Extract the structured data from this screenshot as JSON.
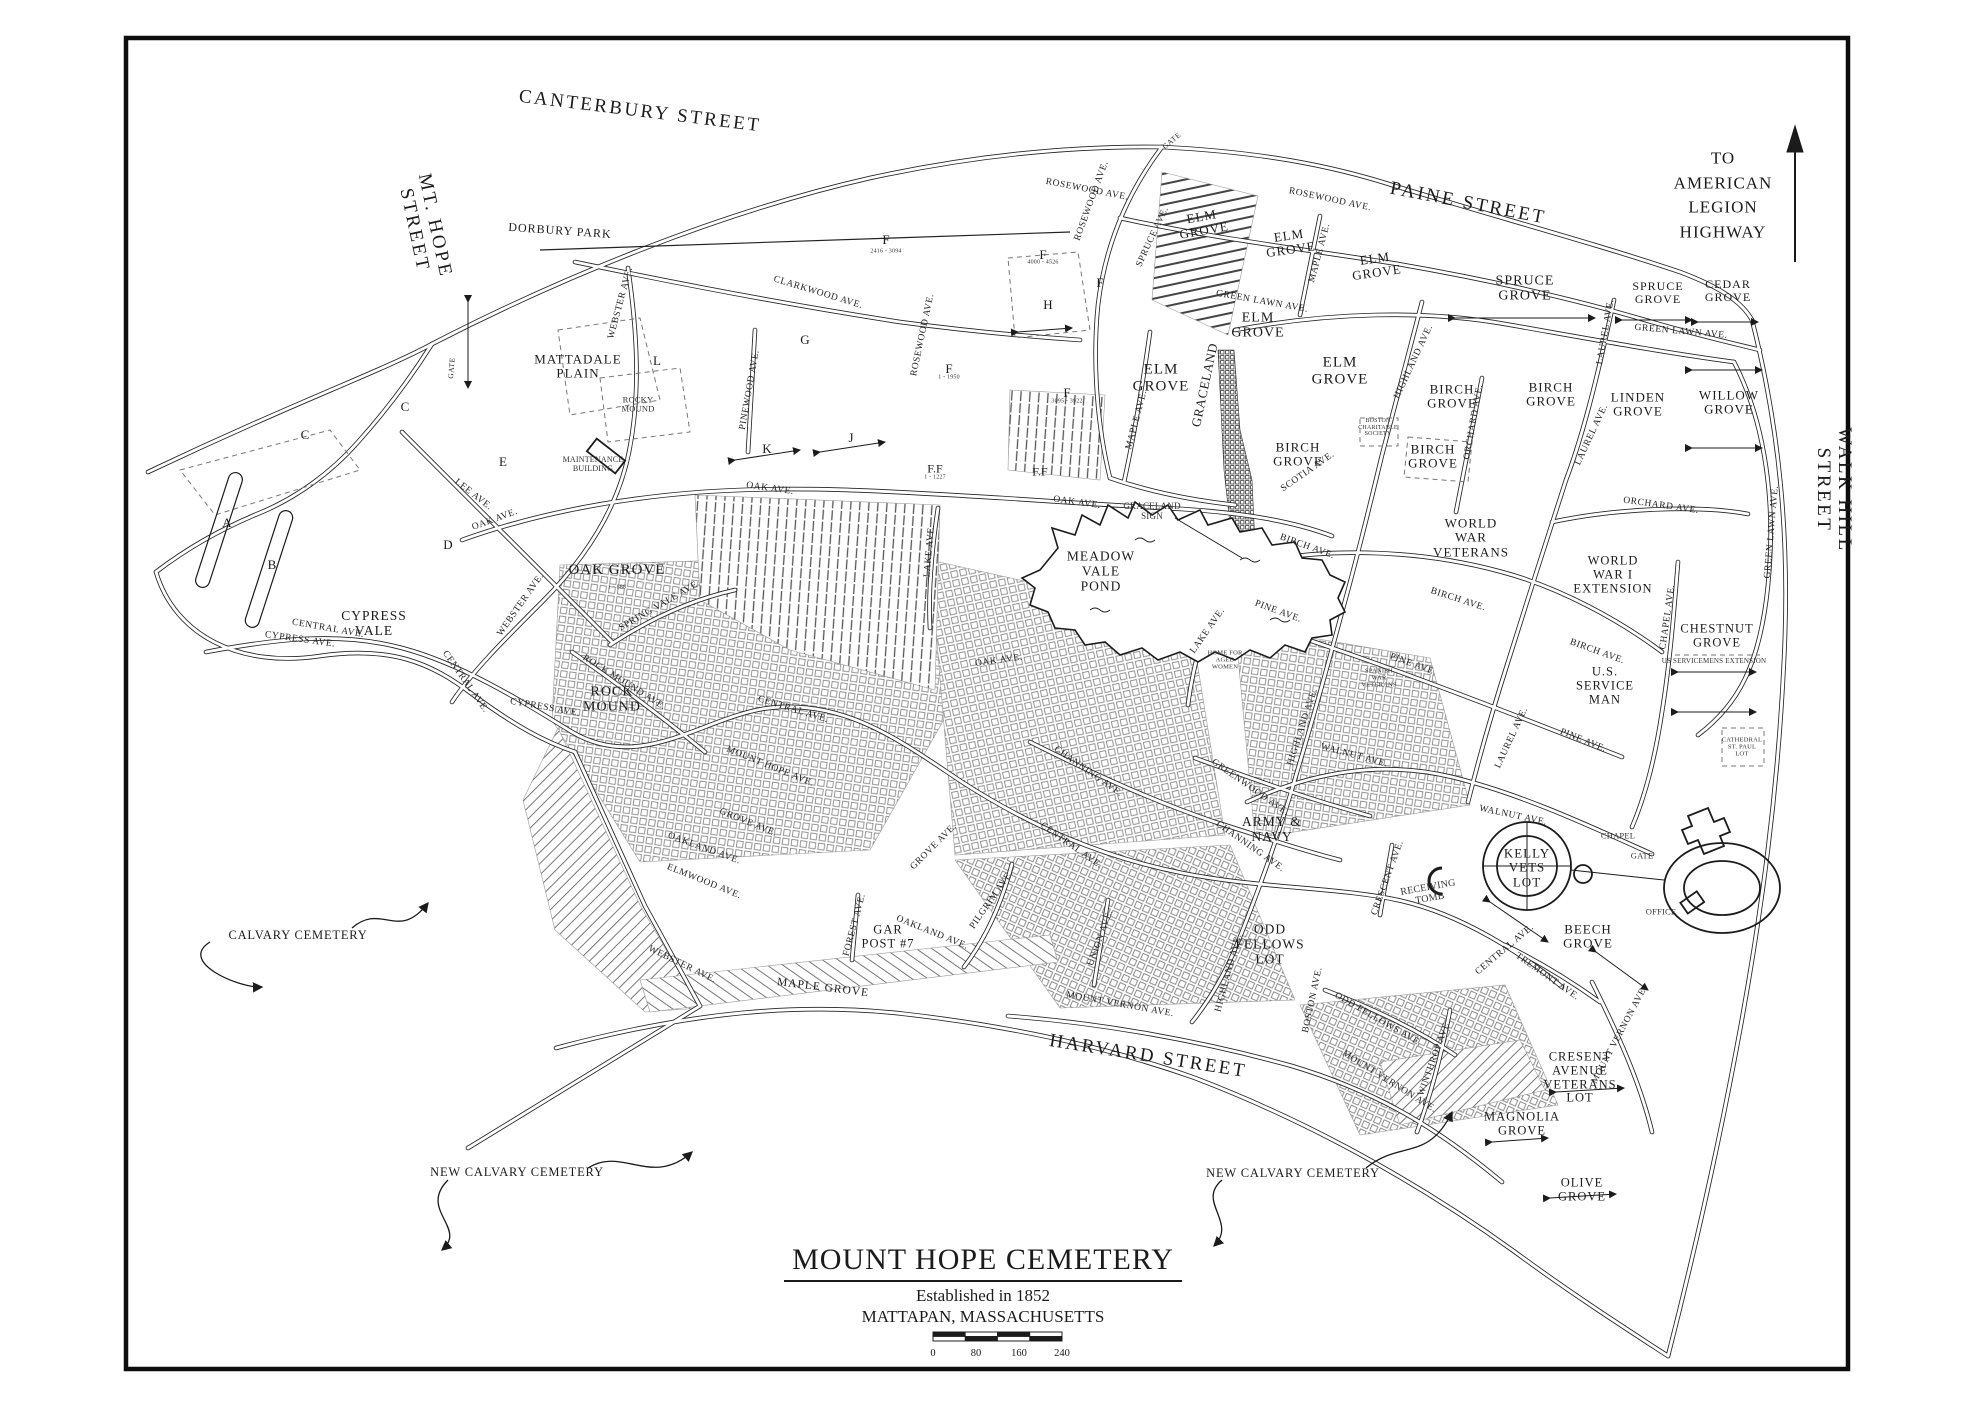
{
  "map": {
    "title": "MOUNT HOPE CEMETERY",
    "subtitle1": "Established in 1852",
    "subtitle2": "MATTAPAN, MASSACHUSETTS",
    "scale_ticks": [
      "0",
      "80",
      "160",
      "240"
    ],
    "north_note": "TO\nAMERICAN\nLEGION\nHIGHWAY",
    "colors": {
      "ink": "#1b1b1b",
      "paper": "#ffffff",
      "texture": "#777777"
    },
    "streets": [
      {
        "t": "CANTERBURY STREET",
        "x": 640,
        "y": 112,
        "r": 7
      },
      {
        "t": "PAINE STREET",
        "x": 1468,
        "y": 204,
        "r": 11
      },
      {
        "t": "MT. HOPE\nSTREET",
        "x": 424,
        "y": 228,
        "r": 78
      },
      {
        "t": "WALK HILL STREET",
        "x": 1833,
        "y": 490,
        "r": 90
      },
      {
        "t": "HARVARD STREET",
        "x": 1148,
        "y": 1057,
        "r": 9
      }
    ],
    "sections": [
      {
        "t": "ELM\nGROVE",
        "x": 1203,
        "y": 224,
        "r": -10,
        "s": 13
      },
      {
        "t": "ELM\nGROVE",
        "x": 1290,
        "y": 243,
        "r": -8,
        "s": 13
      },
      {
        "t": "ELM\nGROVE",
        "x": 1376,
        "y": 266,
        "r": -8,
        "s": 13
      },
      {
        "t": "ELM\nGROVE",
        "x": 1258,
        "y": 326,
        "r": 0,
        "s": 14
      },
      {
        "t": "ELM\nGROVE",
        "x": 1161,
        "y": 378,
        "r": 0,
        "s": 15
      },
      {
        "t": "ELM\nGROVE",
        "x": 1340,
        "y": 371,
        "r": 0,
        "s": 15
      },
      {
        "t": "SPRUCE\nGROVE",
        "x": 1525,
        "y": 289,
        "r": 0,
        "s": 14
      },
      {
        "t": "SPRUCE\nGROVE",
        "x": 1658,
        "y": 293,
        "r": 0,
        "s": 12
      },
      {
        "t": "CEDAR\nGROVE",
        "x": 1728,
        "y": 291,
        "r": 0,
        "s": 12
      },
      {
        "t": "BIRCH\nGROVE",
        "x": 1452,
        "y": 397,
        "r": 0,
        "s": 13
      },
      {
        "t": "BIRCH\nGROVE",
        "x": 1551,
        "y": 395,
        "r": 0,
        "s": 13
      },
      {
        "t": "LINDEN\nGROVE",
        "x": 1638,
        "y": 405,
        "r": 0,
        "s": 13
      },
      {
        "t": "WILLOW\nGROVE",
        "x": 1729,
        "y": 403,
        "r": 0,
        "s": 13
      },
      {
        "t": "BIRCH\nGROVE",
        "x": 1298,
        "y": 455,
        "r": 0,
        "s": 13
      },
      {
        "t": "BIRCH\nGROVE",
        "x": 1433,
        "y": 457,
        "r": 0,
        "s": 13
      },
      {
        "t": "WORLD\nWAR\nVETERANS",
        "x": 1471,
        "y": 538,
        "r": 0,
        "s": 13
      },
      {
        "t": "WORLD\nWAR I\nEXTENSION",
        "x": 1613,
        "y": 575,
        "r": 0,
        "s": 12.5
      },
      {
        "t": "CHESTNUT\nGROVE",
        "x": 1717,
        "y": 636,
        "r": 0,
        "s": 12.5
      },
      {
        "t": "U.S.\nSERVICE\nMAN",
        "x": 1605,
        "y": 686,
        "r": 0,
        "s": 12.5
      },
      {
        "t": "MEADOW\nVALE\nPOND",
        "x": 1101,
        "y": 572,
        "r": 0,
        "s": 13.5
      },
      {
        "t": "OAK GROVE",
        "x": 617,
        "y": 570,
        "r": 0,
        "s": 15
      },
      {
        "t": "CYPRESS\nVALE",
        "x": 374,
        "y": 624,
        "r": 0,
        "s": 13.5
      },
      {
        "t": "ROCK\nMOUND",
        "x": 612,
        "y": 700,
        "r": 0,
        "s": 14
      },
      {
        "t": "MATTADALE\nPLAIN",
        "x": 578,
        "y": 367,
        "r": 0,
        "s": 13
      },
      {
        "t": "KELLY\nVETS\nLOT",
        "x": 1527,
        "y": 868,
        "r": 0,
        "s": 13
      },
      {
        "t": "BEECH\nGROVE",
        "x": 1588,
        "y": 937,
        "r": 0,
        "s": 13
      },
      {
        "t": "ODD\nFELLOWS\nLOT",
        "x": 1270,
        "y": 945,
        "r": 0,
        "s": 13.5
      },
      {
        "t": "ARMY &\nNAVY",
        "x": 1272,
        "y": 830,
        "r": 0,
        "s": 13.5
      },
      {
        "t": "GAR\nPOST #7",
        "x": 888,
        "y": 937,
        "r": 0,
        "s": 12.5
      },
      {
        "t": "CRESENT\nAVENUE\nVETERANS\nLOT",
        "x": 1580,
        "y": 1078,
        "r": 0,
        "s": 12.5
      },
      {
        "t": "MAGNOLIA\nGROVE",
        "x": 1522,
        "y": 1124,
        "r": 0,
        "s": 12.5
      },
      {
        "t": "OLIVE\nGROVE",
        "x": 1582,
        "y": 1190,
        "r": 0,
        "s": 12.5
      },
      {
        "t": "DORBURY PARK",
        "x": 560,
        "y": 231,
        "r": 4,
        "s": 12
      },
      {
        "t": "MAPLE GROVE",
        "x": 823,
        "y": 988,
        "r": 7,
        "s": 11.5
      }
    ],
    "letters": [
      {
        "t": "A",
        "x": 227,
        "y": 523
      },
      {
        "t": "B",
        "x": 272,
        "y": 565
      },
      {
        "t": "C",
        "x": 305,
        "y": 435
      },
      {
        "t": "C",
        "x": 405,
        "y": 407
      },
      {
        "t": "D",
        "x": 448,
        "y": 545
      },
      {
        "t": "E",
        "x": 503,
        "y": 462
      },
      {
        "t": "G",
        "x": 805,
        "y": 340
      },
      {
        "t": "H",
        "x": 1048,
        "y": 305
      },
      {
        "t": "J",
        "x": 851,
        "y": 438
      },
      {
        "t": "K",
        "x": 767,
        "y": 449
      },
      {
        "t": "L",
        "x": 657,
        "y": 361
      },
      {
        "t": "F",
        "x": 886,
        "y": 240
      },
      {
        "t": "F",
        "x": 1043,
        "y": 255
      },
      {
        "t": "F",
        "x": 1100,
        "y": 283
      },
      {
        "t": "F",
        "x": 949,
        "y": 369
      },
      {
        "t": "F",
        "x": 1067,
        "y": 393
      },
      {
        "t": "F.F",
        "x": 935,
        "y": 469,
        "s": 12
      },
      {
        "t": "F.F",
        "x": 1040,
        "y": 472,
        "s": 12
      }
    ],
    "avenues": [
      {
        "t": "ROSEWOOD AVE.",
        "x": 1092,
        "y": 201,
        "r": -70
      },
      {
        "t": "ROSEWOOD AVE.",
        "x": 1087,
        "y": 190,
        "r": 11
      },
      {
        "t": "ROSEWOOD AVE.",
        "x": 1330,
        "y": 200,
        "r": 12
      },
      {
        "t": "ROSEWOOD AVE.",
        "x": 923,
        "y": 335,
        "r": -78
      },
      {
        "t": "CLARKWOOD AVE.",
        "x": 818,
        "y": 293,
        "r": 17
      },
      {
        "t": "PINEWOOD AVE.",
        "x": 750,
        "y": 390,
        "r": -80
      },
      {
        "t": "WEBSTER AVE.",
        "x": 621,
        "y": 303,
        "r": -75
      },
      {
        "t": "GATE",
        "x": 452,
        "y": 368,
        "r": -85,
        "s": 7.5
      },
      {
        "t": "GATE",
        "x": 1172,
        "y": 141,
        "r": -40,
        "s": 7.5
      },
      {
        "t": "OAK AVE.",
        "x": 495,
        "y": 520,
        "r": -20
      },
      {
        "t": "OAK AVE.",
        "x": 770,
        "y": 489,
        "r": 8
      },
      {
        "t": "OAK AVE.",
        "x": 1077,
        "y": 503,
        "r": 8
      },
      {
        "t": "OAK AVE.",
        "x": 999,
        "y": 661,
        "r": -8
      },
      {
        "t": "LEE AVE.",
        "x": 473,
        "y": 495,
        "r": 38
      },
      {
        "t": "CENTRAL AVE.",
        "x": 328,
        "y": 629,
        "r": 10
      },
      {
        "t": "CENTRAL AVE.",
        "x": 465,
        "y": 682,
        "r": 55
      },
      {
        "t": "CENTRAL AVE.",
        "x": 793,
        "y": 710,
        "r": 17
      },
      {
        "t": "CENTRAL AVE.",
        "x": 1071,
        "y": 846,
        "r": 35
      },
      {
        "t": "CENTRAL AVE.",
        "x": 1505,
        "y": 950,
        "r": -40
      },
      {
        "t": "CYPRESS AVE.",
        "x": 300,
        "y": 640,
        "r": 8
      },
      {
        "t": "CYPRESS AVE.",
        "x": 545,
        "y": 708,
        "r": 10
      },
      {
        "t": "WEBSTER AVE.",
        "x": 521,
        "y": 605,
        "r": -55
      },
      {
        "t": "WEBSTER AVE.",
        "x": 682,
        "y": 965,
        "r": 26
      },
      {
        "t": "ROCK MOUND AVE.",
        "x": 624,
        "y": 683,
        "r": 32
      },
      {
        "t": "SPRING VALE AVE.",
        "x": 660,
        "y": 606,
        "r": -30
      },
      {
        "t": "MOUNT HOPE AVE.",
        "x": 770,
        "y": 767,
        "r": 22
      },
      {
        "t": "GROVE AVE.",
        "x": 748,
        "y": 823,
        "r": 22
      },
      {
        "t": "GROVE AVE.",
        "x": 934,
        "y": 847,
        "r": -45
      },
      {
        "t": "OAKLAND AVE.",
        "x": 704,
        "y": 849,
        "r": 20
      },
      {
        "t": "OAKLAND AVE.",
        "x": 932,
        "y": 933,
        "r": 22
      },
      {
        "t": "ELMWOOD AVE.",
        "x": 704,
        "y": 882,
        "r": 22
      },
      {
        "t": "FOREST AVE.",
        "x": 855,
        "y": 925,
        "r": -75
      },
      {
        "t": "PILGRIM AVE.",
        "x": 992,
        "y": 900,
        "r": -55
      },
      {
        "t": "UNION AVE.",
        "x": 1101,
        "y": 938,
        "r": -70
      },
      {
        "t": "CHANNING AVE.",
        "x": 1088,
        "y": 772,
        "r": 35
      },
      {
        "t": "CHANNING AVE.",
        "x": 1250,
        "y": 847,
        "r": 35
      },
      {
        "t": "GREENWOOD AVE.",
        "x": 1250,
        "y": 788,
        "r": 35
      },
      {
        "t": "HIGHLAND AVE.",
        "x": 1414,
        "y": 362,
        "r": -65
      },
      {
        "t": "HIGHLAND AVE.",
        "x": 1303,
        "y": 727,
        "r": -72
      },
      {
        "t": "HIGHLAND AVE.",
        "x": 1229,
        "y": 973,
        "r": -75
      },
      {
        "t": "ORCHARD AVE.",
        "x": 1474,
        "y": 422,
        "r": -80
      },
      {
        "t": "ORCHARD AVE.",
        "x": 1661,
        "y": 506,
        "r": 8
      },
      {
        "t": "LAUREL AVE.",
        "x": 1606,
        "y": 332,
        "r": -80
      },
      {
        "t": "LAUREL AVE.",
        "x": 1592,
        "y": 435,
        "r": -65
      },
      {
        "t": "LAUREL AVE.",
        "x": 1512,
        "y": 738,
        "r": -65
      },
      {
        "t": "SCOTIA AVE.",
        "x": 1308,
        "y": 472,
        "r": -35
      },
      {
        "t": "BIRCH AVE.",
        "x": 1307,
        "y": 547,
        "r": 20
      },
      {
        "t": "BIRCH AVE.",
        "x": 1597,
        "y": 652,
        "r": 20
      },
      {
        "t": "BIRCH AVE.",
        "x": 1458,
        "y": 600,
        "r": 18
      },
      {
        "t": "CHAPEL AVE.",
        "x": 1668,
        "y": 617,
        "r": -82
      },
      {
        "t": "PINE AVE.",
        "x": 1583,
        "y": 741,
        "r": 22
      },
      {
        "t": "PINE AVE.",
        "x": 1278,
        "y": 612,
        "r": 20
      },
      {
        "t": "PINE AVE.",
        "x": 1413,
        "y": 665,
        "r": 20
      },
      {
        "t": "WALNUT AVE.",
        "x": 1354,
        "y": 756,
        "r": 15
      },
      {
        "t": "WALNUT AVE.",
        "x": 1513,
        "y": 816,
        "r": 12
      },
      {
        "t": "LAKE AVE.",
        "x": 1208,
        "y": 631,
        "r": -55
      },
      {
        "t": "LAKE AVE.",
        "x": 930,
        "y": 551,
        "r": -85
      },
      {
        "t": "GREEN LAWN AVE.",
        "x": 1262,
        "y": 302,
        "r": 10
      },
      {
        "t": "GREEN LAWN AVE.",
        "x": 1681,
        "y": 332,
        "r": 5
      },
      {
        "t": "GREEN LAWN AVE.",
        "x": 1772,
        "y": 532,
        "r": -85
      },
      {
        "t": "MAPLE AVE.",
        "x": 1320,
        "y": 253,
        "r": -75
      },
      {
        "t": "MAPLE AVE.",
        "x": 1137,
        "y": 420,
        "r": -75
      },
      {
        "t": "SPRUCE AVE.",
        "x": 1153,
        "y": 237,
        "r": -65
      },
      {
        "t": "MOUNT VERNON AVE.",
        "x": 1120,
        "y": 1005,
        "r": 10
      },
      {
        "t": "MOUNT VERNON AVE.",
        "x": 1389,
        "y": 1082,
        "r": 32
      },
      {
        "t": "MOUNT VERNON AVE.",
        "x": 1620,
        "y": 1035,
        "r": -62
      },
      {
        "t": "WINTHROP AVE.",
        "x": 1435,
        "y": 1058,
        "r": -70
      },
      {
        "t": "ODD FELLOWS AVE.",
        "x": 1378,
        "y": 1020,
        "r": 30
      },
      {
        "t": "BOSTON AVE.",
        "x": 1313,
        "y": 1000,
        "r": -78
      },
      {
        "t": "TREMONT AVE.",
        "x": 1547,
        "y": 977,
        "r": 35
      },
      {
        "t": "CRESCENT AVE.",
        "x": 1388,
        "y": 878,
        "r": -70
      },
      {
        "t": "GRACELAND",
        "x": 1205,
        "y": 385,
        "r": -78,
        "s": 13
      }
    ],
    "small_labels": [
      {
        "t": "ROCKY\nMOUND",
        "x": 638,
        "y": 405,
        "s": 8.5
      },
      {
        "t": "MAINTENANCE\nBUILDING",
        "x": 593,
        "y": 465,
        "s": 8
      },
      {
        "t": "GRACELAND\nSIGN",
        "x": 1152,
        "y": 512,
        "s": 9
      },
      {
        "t": "RECEIVING\nTOMB",
        "x": 1429,
        "y": 893,
        "s": 10,
        "r": -10
      },
      {
        "t": "CHAPEL",
        "x": 1618,
        "y": 836,
        "s": 8.5
      },
      {
        "t": "GATE",
        "x": 1642,
        "y": 856,
        "s": 8.5
      },
      {
        "t": "OFFICE",
        "x": 1661,
        "y": 912,
        "s": 8.5
      },
      {
        "t": "HOME FOR\nAGED\nWOMEN",
        "x": 1225,
        "y": 660,
        "s": 6.5
      },
      {
        "t": "SPANISH\nWAR\nVETERANS",
        "x": 1379,
        "y": 678,
        "s": 6.5
      },
      {
        "t": "US SERVICEMENS EXTENSION",
        "x": 1714,
        "y": 662,
        "s": 7
      },
      {
        "t": "CATHEDRAL\nST. PAUL\nLOT",
        "x": 1742,
        "y": 747,
        "s": 6.5
      },
      {
        "t": "BOSTON\nCHARITABLE\nSOCIETY",
        "x": 1378,
        "y": 428,
        "s": 6
      },
      {
        "t": "1 - 888",
        "x": 617,
        "y": 588,
        "s": 6
      },
      {
        "t": "2416 - 3094",
        "x": 886,
        "y": 252,
        "s": 6
      },
      {
        "t": "4000 - 4526",
        "x": 1043,
        "y": 263,
        "s": 6
      },
      {
        "t": "1 - 1950",
        "x": 949,
        "y": 378,
        "s": 6
      },
      {
        "t": "3095 - 3922",
        "x": 1067,
        "y": 402,
        "s": 6
      },
      {
        "t": "1 - 1227",
        "x": 935,
        "y": 478,
        "s": 6
      }
    ],
    "annotations": [
      {
        "t": "CALVARY CEMETERY",
        "x": 298,
        "y": 936
      },
      {
        "t": "NEW CALVARY CEMETERY",
        "x": 517,
        "y": 1173
      },
      {
        "t": "NEW CALVARY CEMETERY",
        "x": 1293,
        "y": 1174
      }
    ]
  }
}
